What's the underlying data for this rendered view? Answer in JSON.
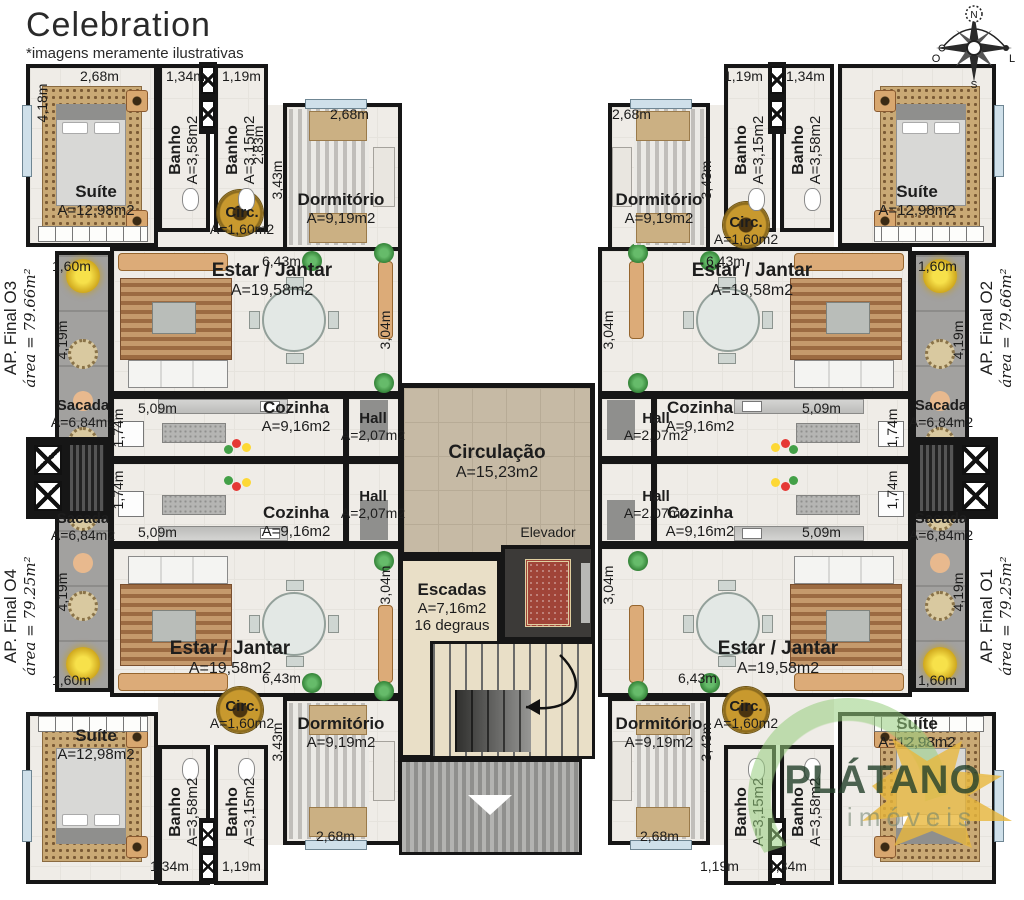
{
  "title": "Celebration",
  "disclaimer": "*imagens meramente ilustrativas",
  "compass": {
    "n": "N",
    "o": "O",
    "l": "L",
    "s": "S"
  },
  "apartments": {
    "o3": {
      "name": "AP. Final O3",
      "area": "área = 79.66m²"
    },
    "o4": {
      "name": "AP. Final O4",
      "area": "área = 79.25m²"
    },
    "o2": {
      "name": "AP. Final O2",
      "area": "área = 79.66m²"
    },
    "o1": {
      "name": "AP. Final O1",
      "area": "área = 79.25m²"
    }
  },
  "rooms": {
    "suite": {
      "name": "Suíte",
      "area": "A=12,98m2"
    },
    "banho358": {
      "name": "Banho",
      "area": "A=3,58m2"
    },
    "banho315": {
      "name": "Banho",
      "area": "A=3,15m2"
    },
    "dormitorio": {
      "name": "Dormitório",
      "area": "A=9,19m2"
    },
    "circ": {
      "name": "Circ.",
      "area": "A=1,60m2"
    },
    "estar": {
      "name": "Estar / Jantar",
      "area": "A=19,58m2"
    },
    "cozinha": {
      "name": "Cozinha",
      "area": "A=9,16m2"
    },
    "hall": {
      "name": "Hall",
      "area": "A=2,07m2"
    },
    "sacada": {
      "name": "Sacada",
      "area": "A=6,84m2"
    }
  },
  "core": {
    "circulacao": {
      "name": "Circulação",
      "area": "A=15,23m2"
    },
    "elevador": {
      "name": "Elevador"
    },
    "escadas": {
      "name": "Escadas",
      "area": "A=7,16m2",
      "steps": "16 degraus"
    }
  },
  "dims": {
    "d268": "2,68m",
    "d418": "4,18m",
    "d134": "1,34m",
    "d119": "1,19m",
    "d283": "2,83m",
    "d343": "3,43m",
    "d643": "6,43m",
    "d304": "3,04m",
    "d160": "1,60m",
    "d419": "4,19m",
    "d509": "5,09m",
    "d174": "1,74m"
  },
  "watermark": {
    "brand": "PLÁTANO",
    "sub": "imóveis"
  },
  "colors": {
    "wall": "#161616",
    "floor": "#efece7",
    "balcony": "#a2a19f",
    "core_floor": "#c6baa5",
    "stair_floor": "#e9dfc7",
    "circ_gold": "#b98a1e",
    "plant_green": "#3d8b37",
    "flower_yellow": "#f0d23c"
  }
}
